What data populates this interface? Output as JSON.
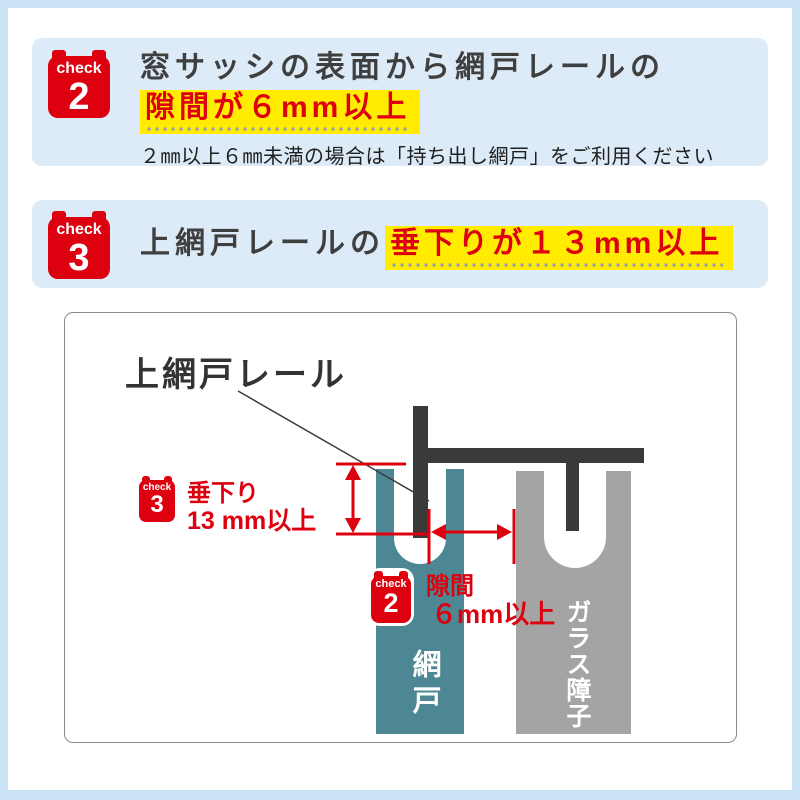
{
  "colors": {
    "accent_red": "#dd000f",
    "highlight_yellow": "#ffec00",
    "panel_blue": "#dcebf7",
    "frame_blue": "#c9e2f4",
    "teal": "#4d8793",
    "gray": "#a4a4a4",
    "charcoal": "#3a3a3a",
    "text_dark": "#3f3f3f"
  },
  "check2_panel": {
    "badge": {
      "word": "check",
      "number": "2"
    },
    "title_line1": "窓サッシの表面から網戸レールの",
    "title_highlight": "隙間が６mm以上",
    "note": "２㎜以上６㎜未満の場合は「持ち出し網戸」をご利用ください"
  },
  "check3_panel": {
    "badge": {
      "word": "check",
      "number": "3"
    },
    "title_plain": "上網戸レールの",
    "title_highlight": "垂下りが１３mm以上"
  },
  "diagram": {
    "rail_label": "上網戸レール",
    "drop_measure": {
      "badge": {
        "word": "check",
        "number": "3"
      },
      "line1": "垂下り",
      "line2": "13 mm以上"
    },
    "gap_measure": {
      "badge": {
        "word": "check",
        "number": "2"
      },
      "line1": "隙間",
      "line2": "６mm以上"
    },
    "screen_label": "網戸",
    "glass_label": "ガラス障子"
  }
}
